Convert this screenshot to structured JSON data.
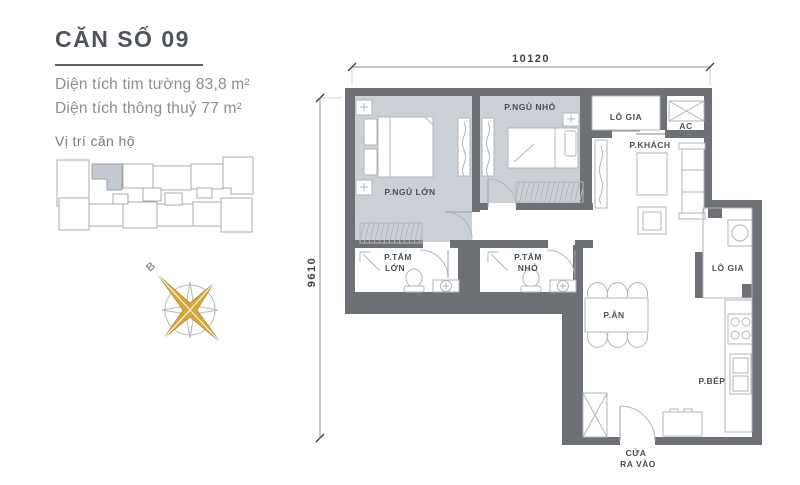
{
  "header": {
    "title": "CĂN SỐ 09",
    "area_line1": "Diện tích tim tường 83,8 m²",
    "area_line2": "Diện tích thông thuỷ 77 m²"
  },
  "location": {
    "label": "Vị trí căn hộ"
  },
  "compass": {
    "north_label": "B"
  },
  "plan": {
    "dimensions": {
      "top": "10120",
      "left": "9610"
    },
    "rooms": {
      "master_bedroom": "P.NGỦ LỚN",
      "small_bedroom": "P.NGỦ NHỎ",
      "living": "P.KHÁCH",
      "loggia_top": "LÔ GIA",
      "loggia_side": "LÔ GIA",
      "ac": "AC",
      "bath_large_l1": "P.TẮM",
      "bath_large_l2": "LỚN",
      "bath_small_l1": "P.TẮM",
      "bath_small_l2": "NHỎ",
      "dining": "P.ĂN",
      "kitchen": "P.BẾP",
      "entrance_l1": "CỬA",
      "entrance_l2": "RA VÀO"
    }
  },
  "colors": {
    "wall": "#6d7175",
    "bedroom_floor": "#c9d0d6",
    "compass_gold": "#d9a733",
    "title_text": "#4f545a",
    "muted_text": "#8a8e92",
    "line_gray": "#b2b6ba"
  }
}
